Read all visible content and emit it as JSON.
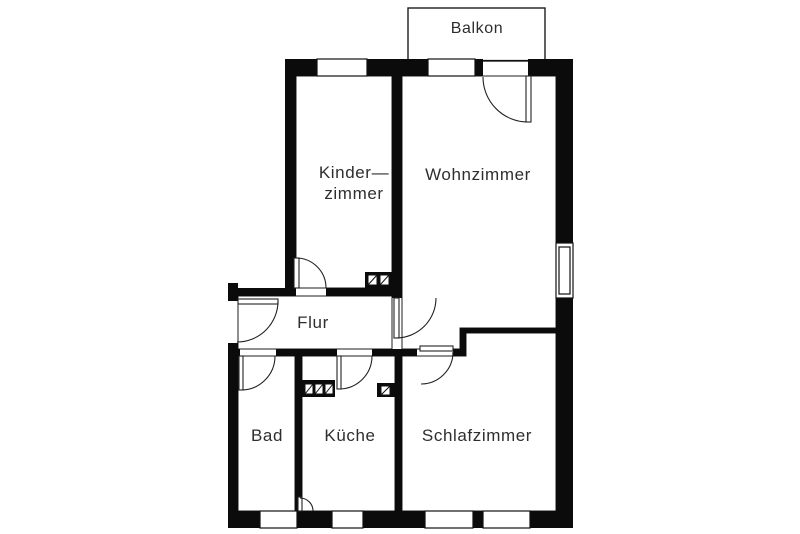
{
  "diagram": {
    "type": "floor-plan",
    "rooms": {
      "balkon": "Balkon",
      "kinderzimmer_line1": "Kinder—",
      "kinderzimmer_line2": "zimmer",
      "wohnzimmer": "Wohnzimmer",
      "flur": "Flur",
      "bad": "Bad",
      "kueche": "Küche",
      "schlafzimmer": "Schlafzimmer"
    },
    "colors": {
      "wall": "#0b0b0b",
      "thin_line": "#1c1c1c",
      "text": "#2e2e2e",
      "background": "#ffffff"
    }
  }
}
